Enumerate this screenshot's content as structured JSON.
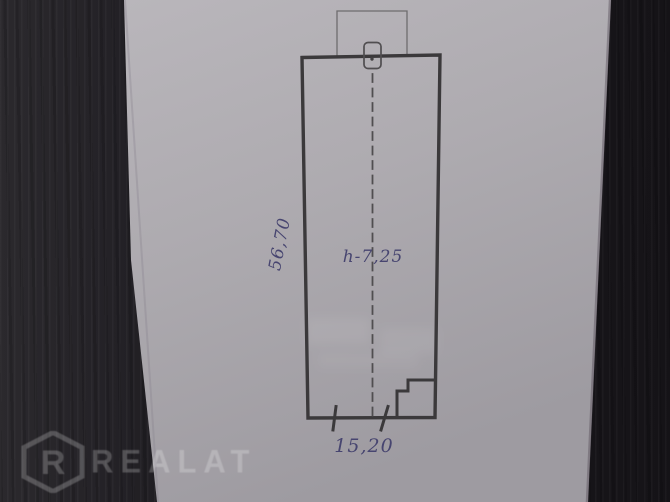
{
  "watermark": {
    "brand": "REALAT",
    "logo_letter": "R"
  },
  "floor_plan": {
    "length_label": "56,70",
    "height_label": "h-7,25",
    "width_label": "15,20"
  },
  "colors": {
    "ink": "#474570",
    "plan_line": "#3b393b",
    "thin_line": "#6e6c6e",
    "marker_line": "#504e50",
    "paper": "#aeabb0",
    "wood": "#1d1b1f",
    "watermark": "rgba(255,255,255,0.22)"
  }
}
